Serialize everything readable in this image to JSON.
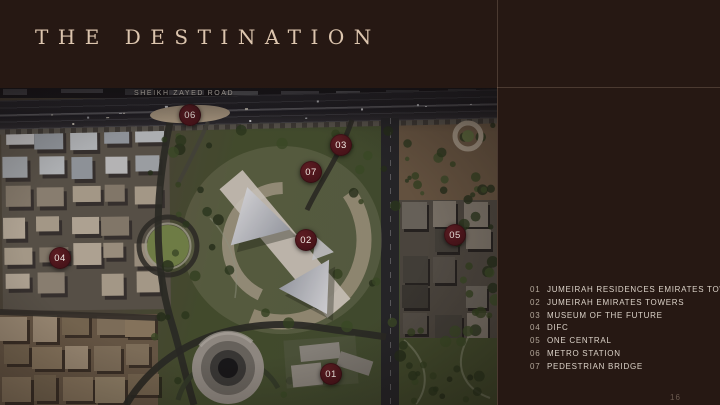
{
  "slide": {
    "title": "THE DESTINATION",
    "page_mark": "16"
  },
  "map": {
    "road_label": "SHEIKH ZAYED ROAD",
    "markers": [
      {
        "num": "01",
        "x": 331,
        "y": 286
      },
      {
        "num": "02",
        "x": 306,
        "y": 152
      },
      {
        "num": "03",
        "x": 341,
        "y": 57
      },
      {
        "num": "04",
        "x": 60,
        "y": 170
      },
      {
        "num": "05",
        "x": 455,
        "y": 147
      },
      {
        "num": "06",
        "x": 190,
        "y": 27
      },
      {
        "num": "07",
        "x": 311,
        "y": 84
      }
    ]
  },
  "legend": {
    "items": [
      {
        "num": "01",
        "label": "JUMEIRAH RESIDENCES EMIRATES TOWERS"
      },
      {
        "num": "02",
        "label": "JUMEIRAH EMIRATES TOWERS"
      },
      {
        "num": "03",
        "label": "MUSEUM OF THE FUTURE"
      },
      {
        "num": "04",
        "label": "DIFC"
      },
      {
        "num": "05",
        "label": "ONE CENTRAL"
      },
      {
        "num": "06",
        "label": "METRO STATION"
      },
      {
        "num": "07",
        "label": "PEDESTRIAN BRIDGE"
      }
    ]
  },
  "colors": {
    "background": "#261813",
    "line": "rgba(186,160,138,0.25)",
    "title_text": "#dcc5ae",
    "legend_num": "#b3a79a",
    "legend_label": "#dbd2c8",
    "marker_bg": "#471319",
    "marker_text": "#f2e9e3",
    "road_label": "#ece4da"
  }
}
